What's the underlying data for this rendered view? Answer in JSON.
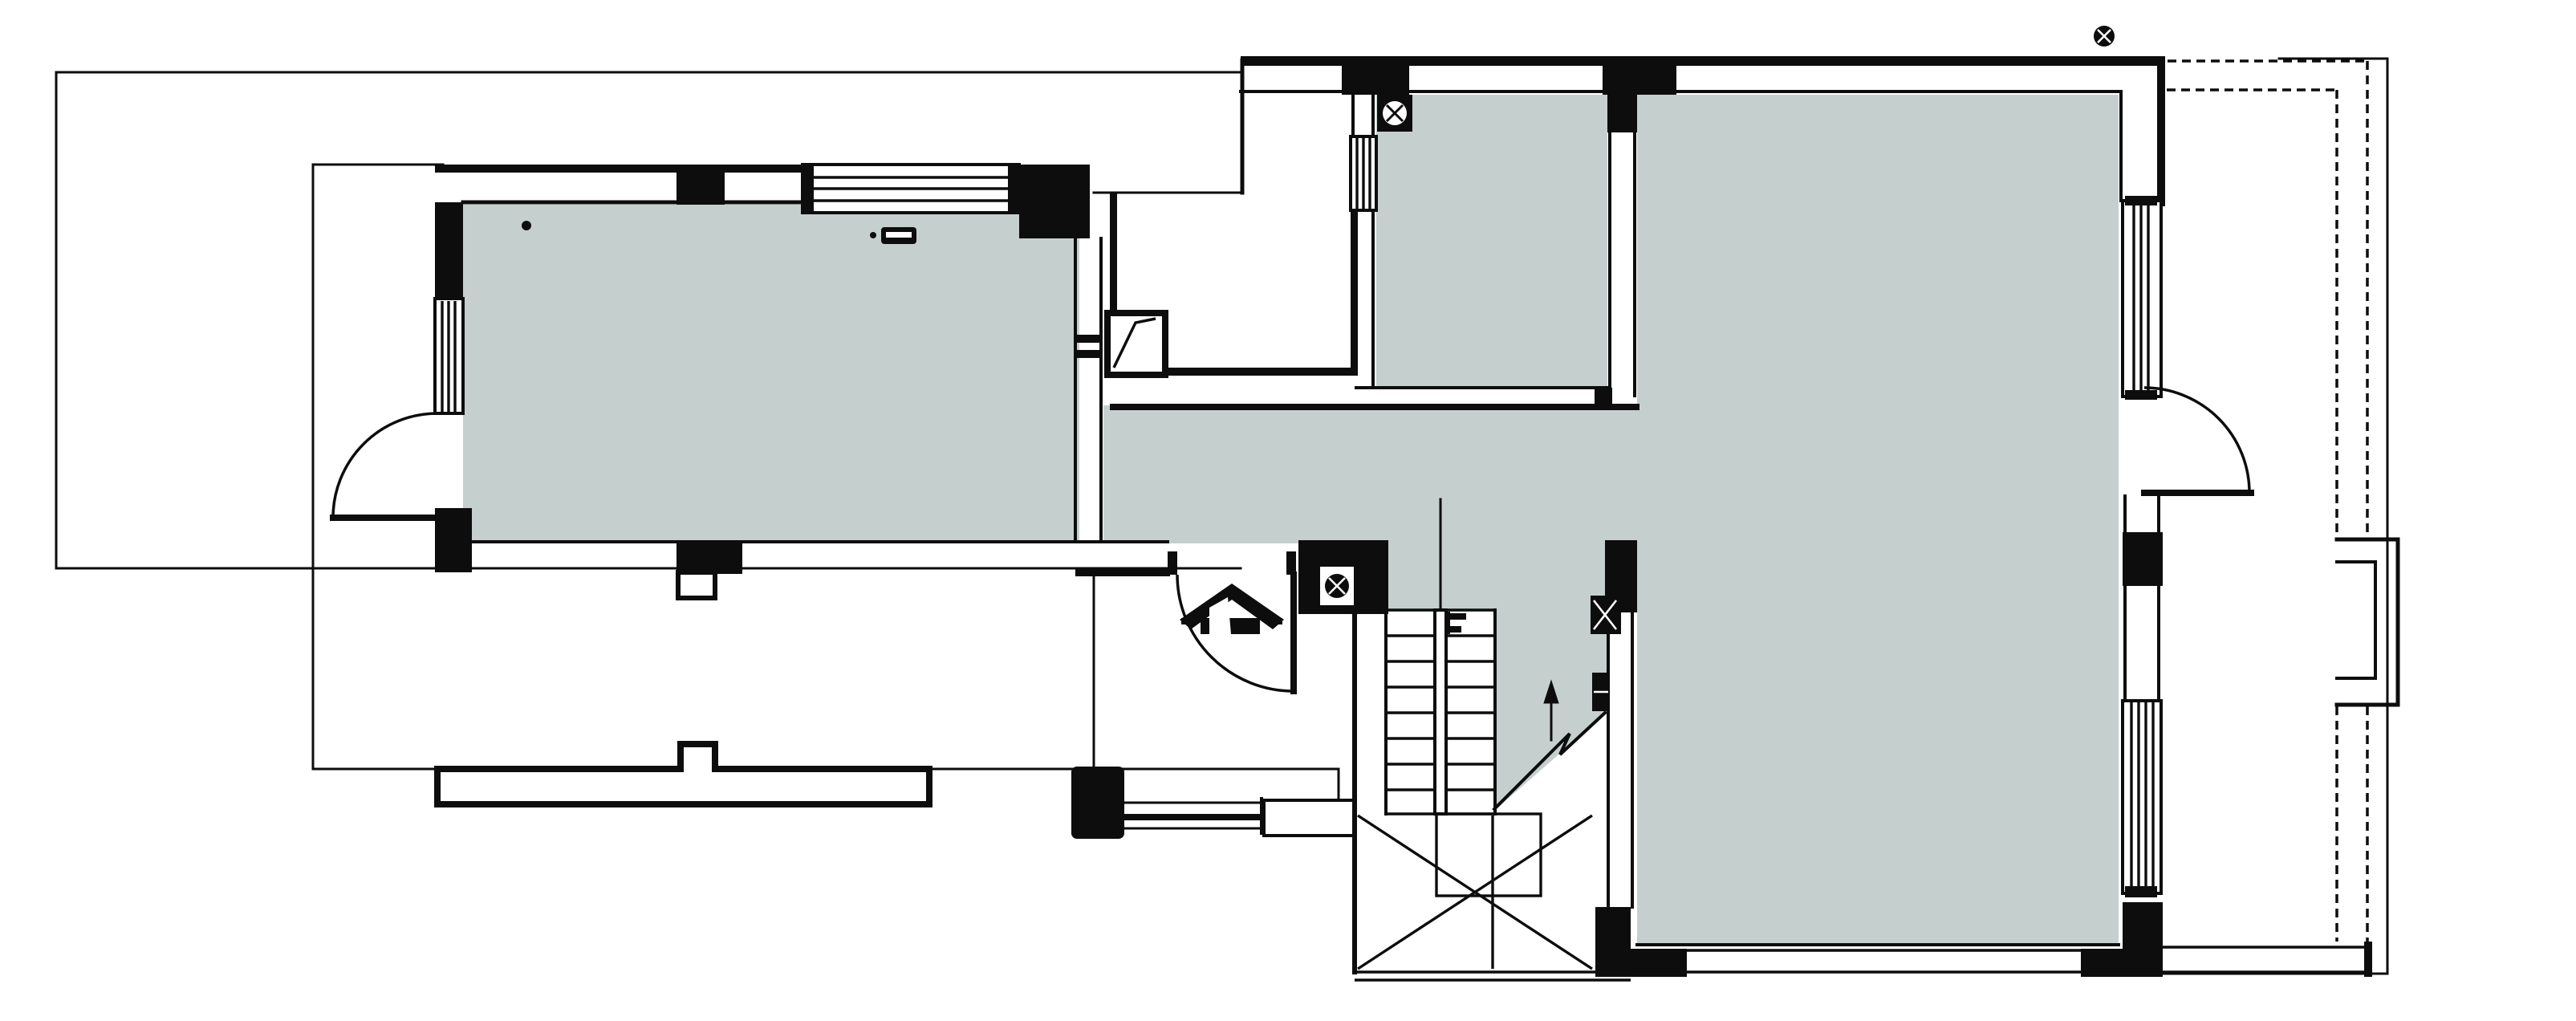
{
  "document": {
    "type": "architectural floor plan",
    "view": "ground floor plan, top-down CAD drawing",
    "visible_text": ""
  },
  "colors": {
    "background": "#ffffff",
    "line": "#0d0d0d",
    "wall": "#0d0d0d",
    "room_fill": "#c5d0ce",
    "symbol_white": "#ffffff"
  },
  "rooms": [
    {
      "id": "room-west",
      "filled": true
    },
    {
      "id": "hallway",
      "filled": true
    },
    {
      "id": "room-north-small",
      "filled": true
    },
    {
      "id": "room-east-large",
      "filled": true
    },
    {
      "id": "stair-landing",
      "filled": true
    },
    {
      "id": "entry-vestibule",
      "filled": false
    },
    {
      "id": "patio-court",
      "filled": false
    }
  ],
  "symbols": {
    "registration_mark": {
      "name": "target-circle-icon",
      "position": "top-right"
    },
    "entrance_marker": {
      "name": "house-icon",
      "position": "entry-vestibule"
    },
    "floor_drains": {
      "name": "circled-cross-drain-icon",
      "count": 2
    },
    "door_swings": {
      "count": 3
    },
    "direction_arrow": {
      "name": "up-arrow",
      "meaning": "stair up"
    },
    "break_line": {
      "name": "zigzag-break-line"
    },
    "ceiling_hook": {
      "name": "small-dot-icon"
    },
    "wall_fixture": {
      "name": "switch-block-icon"
    }
  },
  "stairs": {
    "type": "half-turn winder stair",
    "straight_treads": 9,
    "has_center_stringer": true,
    "has_inner_square": true
  },
  "windows": {
    "striped_window_count": 6,
    "cavity_wall_openings": "multiple"
  },
  "site": {
    "thin_outline_rectangles": 2,
    "dashed_setback_lines": 2,
    "terrace_strip": true,
    "east_pilaster_bump": true
  }
}
